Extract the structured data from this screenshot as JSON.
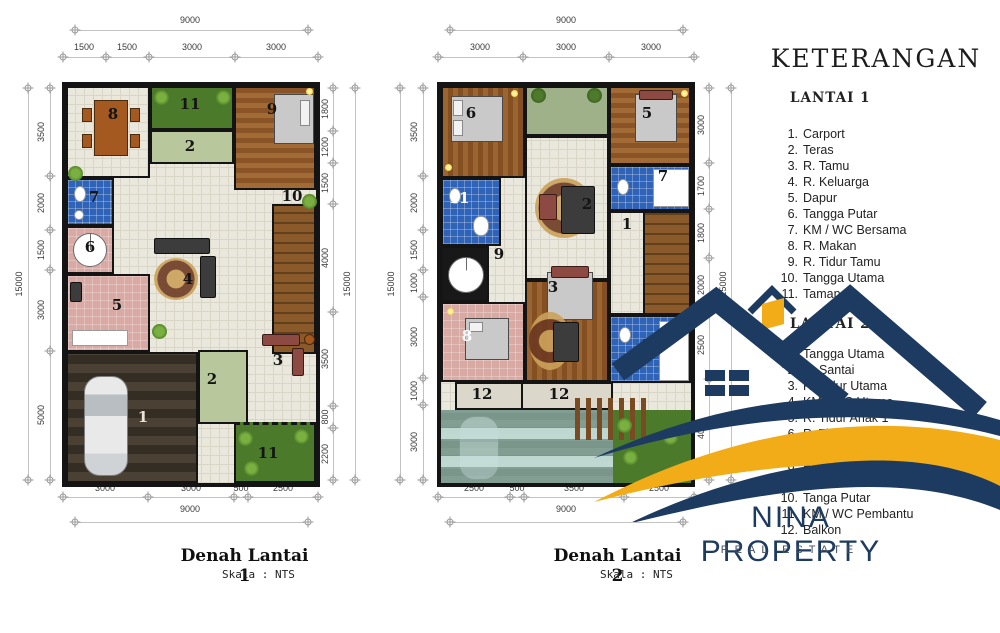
{
  "colors": {
    "navy": "#1d3b60",
    "gold": "#f2ac18",
    "bath_blue": "#2e63b8",
    "garden_green": "#4c7a2b",
    "teras_sage": "#b9c79c",
    "floor_pink": "#d9aaa4",
    "wood_brown": "#9c6430",
    "tile_floor": "#eae8dd",
    "carport_deck": "#4a4034",
    "roof_glass_teal": "#96c6bc"
  },
  "legend": {
    "title": "KETERANGAN",
    "lantai1": {
      "heading": "LANTAI 1",
      "items": [
        {
          "no": "1.",
          "label": "Carport"
        },
        {
          "no": "2.",
          "label": "Teras"
        },
        {
          "no": "3.",
          "label": "R. Tamu"
        },
        {
          "no": "4.",
          "label": "R. Keluarga"
        },
        {
          "no": "5.",
          "label": "Dapur"
        },
        {
          "no": "6.",
          "label": "Tangga Putar"
        },
        {
          "no": "7.",
          "label": "KM / WC Bersama"
        },
        {
          "no": "8.",
          "label": "R. Makan"
        },
        {
          "no": "9.",
          "label": "R. Tidur Tamu"
        },
        {
          "no": "10.",
          "label": "Tangga Utama"
        },
        {
          "no": "11.",
          "label": "Taman"
        }
      ]
    },
    "lantai2": {
      "heading": "LANTAI 2",
      "items": [
        {
          "no": "1.",
          "label": "Tangga Utama"
        },
        {
          "no": "2.",
          "label": "R. Santai"
        },
        {
          "no": "3.",
          "label": "R. Tidur Utama"
        },
        {
          "no": "4.",
          "label": "KM / WC Utama"
        },
        {
          "no": "5.",
          "label": "R. Tidur Anak 1"
        },
        {
          "no": "6.",
          "label": "R. Tidur Anak 2"
        },
        {
          "no": "7.",
          "label": "KM / WC Anak"
        },
        {
          "no": "8.",
          "label": "R. Tidur Pembantu"
        },
        {
          "no": "9.",
          "label": "Hall"
        },
        {
          "no": "10.",
          "label": "Tanga Putar"
        },
        {
          "no": "11.",
          "label": "KM / WC Pembantu"
        },
        {
          "no": "12.",
          "label": "Balkon"
        }
      ]
    }
  },
  "plan1": {
    "title": "Denah Lantai 1",
    "scale": "Skala : NTS",
    "dims": {
      "top_total": "9000",
      "top_segments": [
        "1500",
        "1500",
        "3000",
        "3000"
      ],
      "left_total": "15000",
      "left_segments": [
        "3500",
        "2000",
        "1500",
        "3000",
        "5000"
      ],
      "right_total": "15000",
      "right_segments": [
        "1800",
        "1200",
        "1500",
        "4000",
        "3500",
        "800",
        "2200"
      ],
      "bottom_total": "9000",
      "bottom_segments": [
        "3000",
        "3000",
        "500",
        "2500"
      ]
    },
    "rooms": [
      {
        "n": "8",
        "name": "R. Makan"
      },
      {
        "n": "11",
        "name": "Taman"
      },
      {
        "n": "2",
        "name": "Teras"
      },
      {
        "n": "9",
        "name": "R. Tidur Tamu"
      },
      {
        "n": "7",
        "name": "KM / WC Bersama"
      },
      {
        "n": "6",
        "name": "Tangga Putar"
      },
      {
        "n": "10",
        "name": "Tangga Utama"
      },
      {
        "n": "4",
        "name": "R. Keluarga"
      },
      {
        "n": "5",
        "name": "Dapur"
      },
      {
        "n": "2",
        "name": "Teras"
      },
      {
        "n": "3",
        "name": "R. Tamu"
      },
      {
        "n": "1",
        "name": "Carport"
      },
      {
        "n": "11",
        "name": "Taman"
      }
    ]
  },
  "plan2": {
    "title": "Denah Lantai 2",
    "scale": "Skala : NTS",
    "dims": {
      "top_total": "9000",
      "top_segments": [
        "3000",
        "3000",
        "3000"
      ],
      "left_total": "15000",
      "left_segments": [
        "3500",
        "2000",
        "1500",
        "1000",
        "3000",
        "1000",
        "3000"
      ],
      "right_total": "15000",
      "right_segments": [
        "3000",
        "1700",
        "1800",
        "2000",
        "2500",
        "4000"
      ],
      "bottom_total": "9000",
      "bottom_segments": [
        "2500",
        "500",
        "3500",
        "2500"
      ]
    },
    "rooms": [
      {
        "n": "6",
        "name": "R. Tidur Anak 2"
      },
      {
        "n": "5",
        "name": "R. Tidur Anak 1"
      },
      {
        "n": "11",
        "name": "KM / WC Pembantu"
      },
      {
        "n": "2",
        "name": "R. Santai"
      },
      {
        "n": "7",
        "name": "KM / WC Anak"
      },
      {
        "n": "1",
        "name": "Tangga Utama"
      },
      {
        "n": "10",
        "name": "Tanga Putar"
      },
      {
        "n": "9",
        "name": "Hall"
      },
      {
        "n": "8",
        "name": "R. Tidur Pembantu"
      },
      {
        "n": "3",
        "name": "R. Tidur Utama"
      },
      {
        "n": "4",
        "name": "KM / WC Utama"
      },
      {
        "n": "12",
        "name": "Balkon"
      },
      {
        "n": "12",
        "name": "Balkon"
      }
    ]
  },
  "logo": {
    "name": "NINA PROPERTY",
    "tagline": "REAL ESTATE"
  }
}
